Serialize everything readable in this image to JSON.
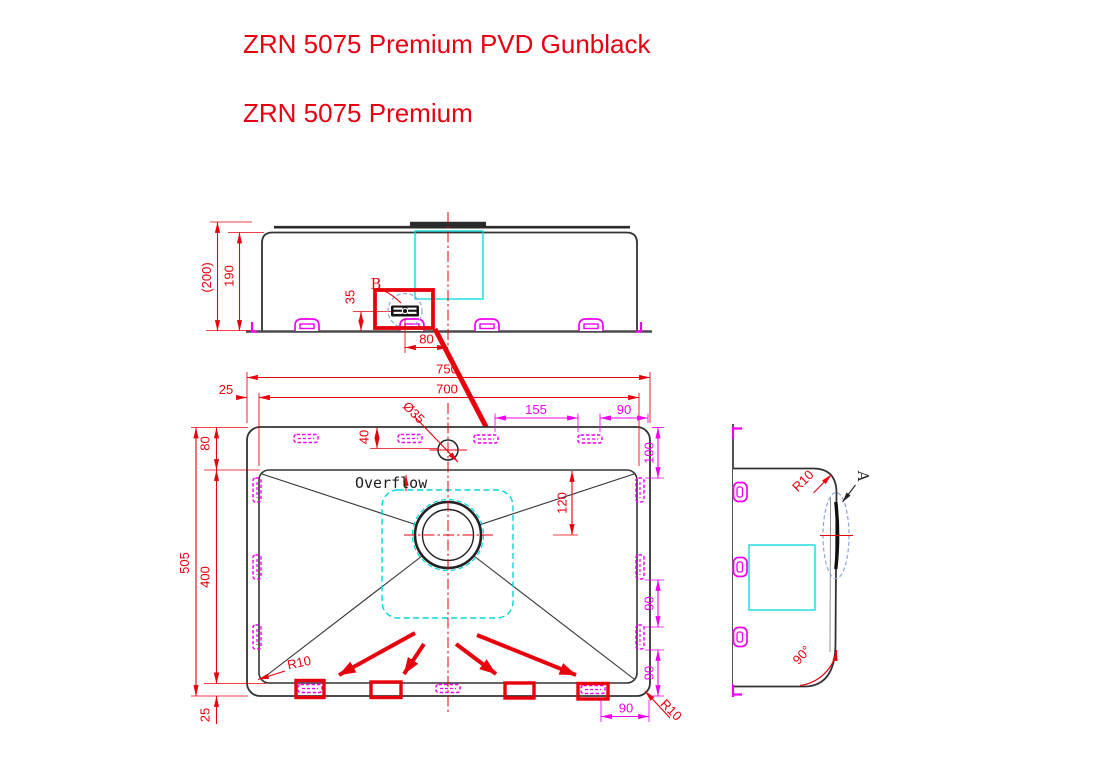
{
  "titles": {
    "line1": "ZRN 5075 Premium PVD Gunblack",
    "line2": "ZRN 5075 Premium"
  },
  "front_view": {
    "dim_overall_height": "(200)",
    "dim_bowl_depth": "190",
    "dim_clip_height": "35",
    "dim_clip_to_center": "80",
    "label_detail_b": "B"
  },
  "plan_view": {
    "dim_overall_width": "750",
    "dim_bowl_width": "700",
    "dim_flange_left": "25",
    "dim_flange_top": "80",
    "dim_hole_offset": "40",
    "label_hole_dia": "Ø35",
    "dim_clip_span_top": "155",
    "dim_clip_edge_top": "90",
    "dim_clip_offset_right": "100",
    "dim_drain_offset": "120",
    "dim_overall_depth": "505",
    "dim_bowl_depth": "400",
    "dim_flange_bottom": "25",
    "dim_clip_span_right_upper": "90",
    "dim_clip_span_right_lower": "90",
    "dim_clip_edge_bottom": "90",
    "label_radius_bottom_left": "R10",
    "label_radius_bottom_right": "R10",
    "label_overflow": "Overflow"
  },
  "side_view": {
    "label_radius": "R10",
    "label_detail_a": "A",
    "label_angle": "90°"
  },
  "colors": {
    "dimension_red": "#e8000d",
    "title_red": "#e60012",
    "clip_magenta": "#f000f0",
    "accent_cyan": "#00d9d9",
    "detail_blue": "#8ba7dc",
    "line_dark": "#333333"
  }
}
